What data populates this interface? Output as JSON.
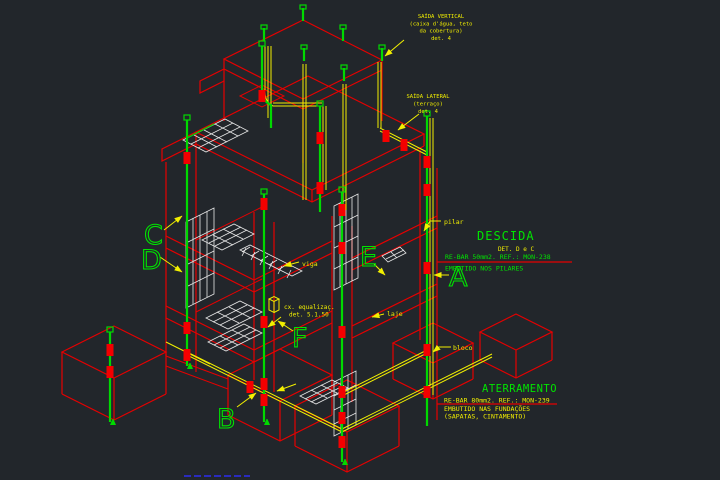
{
  "drawing": {
    "type": "isometric-cad-spda",
    "background": "#22262b"
  },
  "colors": {
    "background": "#22262b",
    "structure_red": "#e60000",
    "conductor_green": "#00d900",
    "conduit_yellow": "#f2ef00",
    "mesh_white": "#e8e8e8",
    "text_yellow": "#f2ef00",
    "text_green": "#00e400",
    "leader_blue": "#2d2df0"
  },
  "ann": {
    "saida_vertical": {
      "l1": "SAÍDA VERTICAL",
      "l2": "(caixa d'água, teto",
      "l3": "da cobertura)",
      "l4": "det. 4"
    },
    "saida_lateral": {
      "l1": "SAÍDA LATERAL",
      "l2": "(terraço)",
      "l3": "det. 4"
    },
    "pilar": "pilar",
    "viga": "viga",
    "laje": "laje",
    "bloco": "bloco",
    "cx": {
      "l1": "cx. equalizaç.",
      "l2": "det. 5.1.50"
    },
    "descida": {
      "title": "DESCIDA",
      "detail": "DET. D e C",
      "spec": "RE-BAR 50mm2. REF.: MON-238",
      "note": "EMBUTIDO NOS PILARES"
    },
    "aterramento": {
      "title": "ATERRAMENTO",
      "spec": "RE-BAR 80mm2. REF.: MON-239",
      "note1": "EMBUTIDO NAS FUNDAÇÕES",
      "note2": "(SAPATAS, CINTAMENTO)"
    },
    "markers": {
      "a": "A",
      "b": "B",
      "c": "C",
      "d": "D",
      "e": "E",
      "f": "F"
    }
  }
}
